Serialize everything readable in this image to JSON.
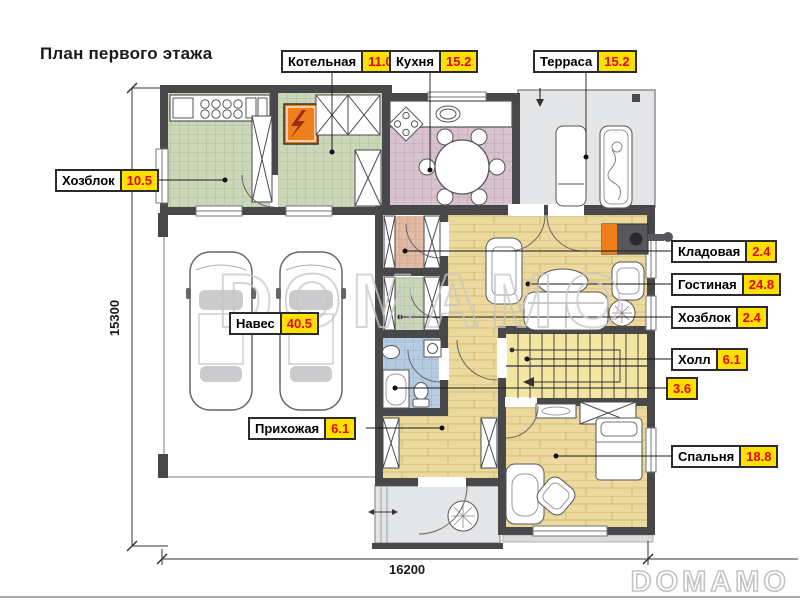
{
  "title": "План первого этажа",
  "rooms": {
    "kotelnaya": {
      "name": "Котельная",
      "area": "11.0"
    },
    "kuhnya": {
      "name": "Кухня",
      "area": "15.2"
    },
    "terrasa": {
      "name": "Терраса",
      "area": "15.2"
    },
    "hozblok_big": {
      "name": "Хозблок",
      "area": "10.5"
    },
    "kladovaya": {
      "name": "Кладовая",
      "area": "2.4"
    },
    "gostinaya": {
      "name": "Гостиная",
      "area": "24.8"
    },
    "hozblok_small": {
      "name": "Хозблок",
      "area": "2.4"
    },
    "holl": {
      "name": "Холл",
      "area": "6.1"
    },
    "sanuzel": {
      "area": "3.6"
    },
    "spalnya": {
      "name": "Спальня",
      "area": "18.8"
    },
    "naves": {
      "name": "Навес",
      "area": "40.5"
    },
    "prihozhaya": {
      "name": "Прихожая",
      "area": "6.1"
    }
  },
  "dimensions": {
    "vertical_mm": "15300",
    "horizontal_mm": "16200"
  },
  "watermark": {
    "center": "DOMAMO",
    "corner": "DOMAMO"
  },
  "colors": {
    "value_badge_bg": "#ffe000",
    "value_badge_text": "#e30613",
    "walls": "#48484a",
    "boiler": "#ee7f1b",
    "wood_floor": "#ebd99e",
    "tile_green": "#cbd7b9",
    "tile_pink": "#d8c2ce",
    "tile_blue": "#b6cde1",
    "tile_salmon": "#e1baa6",
    "terrace_gray": "#e4e5e7"
  }
}
